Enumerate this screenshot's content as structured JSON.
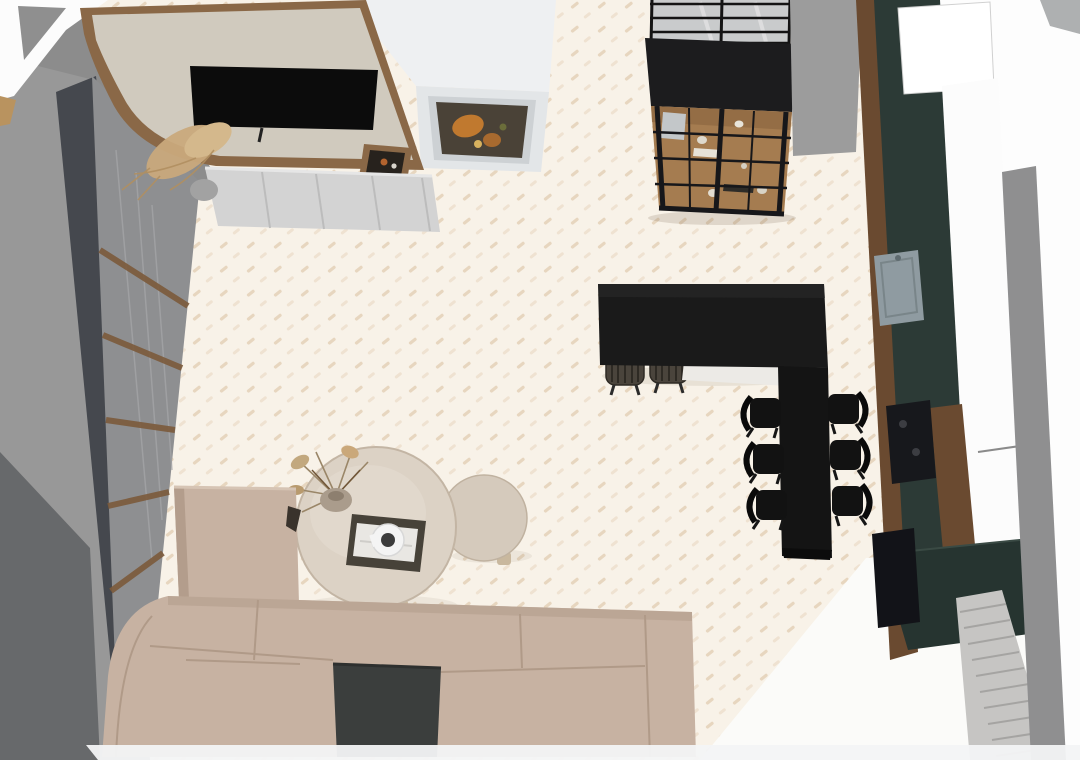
{
  "app": {
    "type": "3d-floorplan-top-view-render",
    "room": "open-plan living room and kitchen",
    "view": "top-down"
  },
  "canvas": {
    "width": 1080,
    "height": 760
  },
  "colors": {
    "floor": "#f8f2e8",
    "floor_fleck": "#e7d6bf",
    "floor_fleck_light": "#efe2d1",
    "wall": "#989898",
    "wall_mid": "#8c8c8c",
    "wall_dark": "#67696b",
    "pelmet": "#45484e",
    "curtain": "#8e8f91",
    "curtain_batten": "#7b5a3b",
    "wood_trim": "#8a6847",
    "tv_panel": "#d0cabe",
    "tv": "#0c0c0c",
    "console": "#d3d3d3",
    "marble": "#eef0f2",
    "marble_side": "#e3e6e8",
    "art_orange": "#c0792f",
    "partition_glass": "#c9cbcc",
    "cabinet": "#1c1c1e",
    "cabinet_wood": "#a57c50",
    "island": "#1a1a1a",
    "dining_table": "#141414",
    "chair": "#121212",
    "stool": "#4a443c",
    "sofa": "#c7b2a2",
    "sofa_shade": "#b39d8c",
    "sofa_insert": "#3b3e3d",
    "coffee_table": "#dcd2c5",
    "side_table": "#d5cabc",
    "counter_green": "#2c3a36",
    "counter_green_dark": "#263430",
    "counter_wood": "#6a4a30",
    "bright_white": "#fdfdfd",
    "sink": "#8f9ba1",
    "appliance": "#17181c",
    "pleat_curtain": "#c6c5c3",
    "baseboard_strip": "#f3f4f6"
  },
  "scene": {
    "living_area_objects": [
      "tv-media-wall",
      "tv-screen",
      "console-shelf",
      "pampas-plant",
      "decor-tray",
      "marble-partition",
      "framed-artwork",
      "window-curtains",
      "sofa-sectional",
      "sofa-tray-insert",
      "coffee-table-large",
      "coffee-table-small",
      "dried-flower-vase",
      "coffee-table-tray"
    ],
    "kitchen_area_objects": [
      "glass-partition",
      "glass-display-cabinet",
      "kitchen-island",
      "bar-stools",
      "dining-table",
      "dining-chairs",
      "counter-run",
      "sink",
      "cooktop",
      "oven",
      "pleated-curtain"
    ],
    "bar_stool_count": 2,
    "dining_chair_count": 6
  }
}
